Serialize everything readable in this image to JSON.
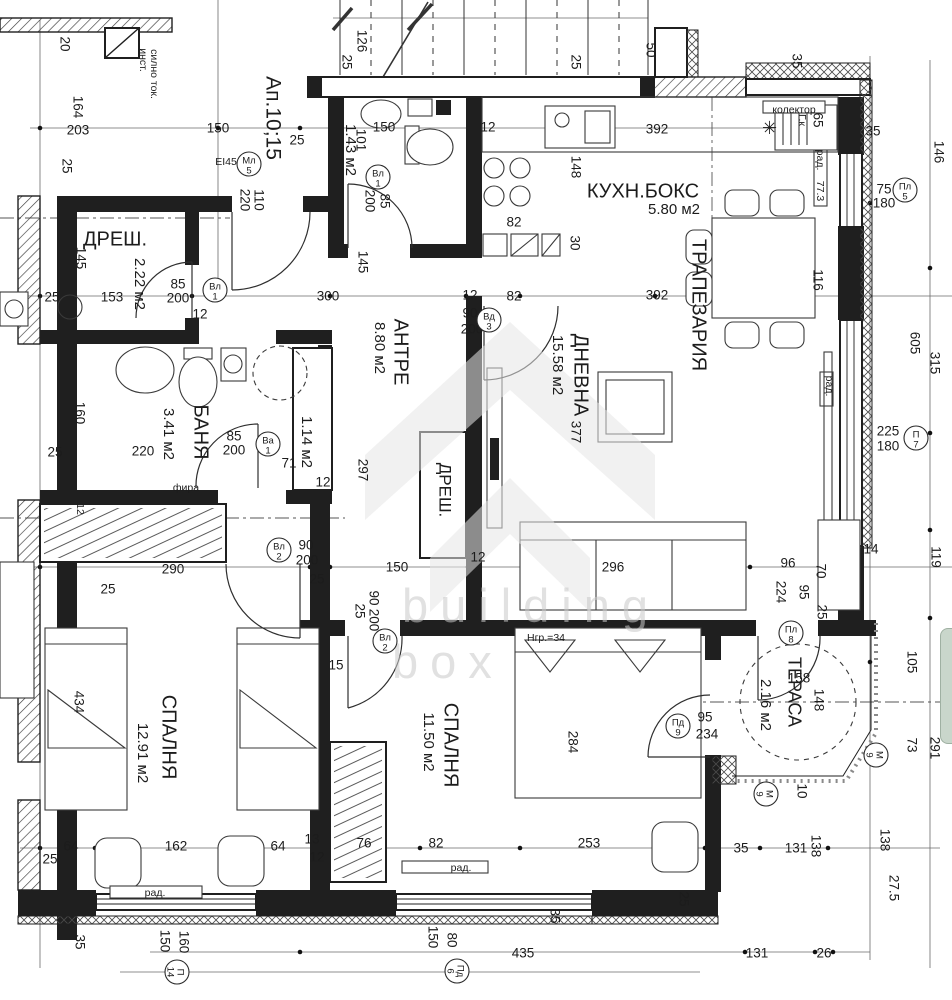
{
  "watermark": {
    "l1": "building",
    "l2": "box"
  },
  "colors": {
    "paper": "#ffffff",
    "ink": "#1f1f1f",
    "watermark": "#c9c9c9",
    "side_tab": "#c9d6cb"
  },
  "labels": [
    {
      "t": "20",
      "x": 64,
      "y": 44,
      "r": 90
    },
    {
      "t": "инст.",
      "x": 143,
      "y": 60,
      "r": 90,
      "k": "small"
    },
    {
      "t": "силно ток.",
      "x": 154,
      "y": 74,
      "r": 90,
      "k": "small"
    },
    {
      "t": "164",
      "x": 77,
      "y": 107,
      "r": 90
    },
    {
      "t": "203",
      "x": 78,
      "y": 131
    },
    {
      "t": "150",
      "x": 218,
      "y": 129
    },
    {
      "t": "25",
      "x": 297,
      "y": 141
    },
    {
      "t": "Ап.10;15",
      "x": 272,
      "y": 118,
      "r": 90,
      "k": "title"
    },
    {
      "t": "25",
      "x": 66,
      "y": 166,
      "r": 90
    },
    {
      "t": "EI45",
      "x": 226,
      "y": 162,
      "k": "small"
    },
    {
      "t": "110",
      "x": 258,
      "y": 200,
      "r": 90
    },
    {
      "t": "220",
      "x": 244,
      "y": 200,
      "r": 90
    },
    {
      "t": "126",
      "x": 361,
      "y": 41,
      "r": 90
    },
    {
      "t": "25",
      "x": 346,
      "y": 62,
      "r": 90
    },
    {
      "t": "25",
      "x": 575,
      "y": 62,
      "r": 90
    },
    {
      "t": "50",
      "x": 650,
      "y": 50,
      "r": 90
    },
    {
      "t": "35",
      "x": 796,
      "y": 61,
      "r": 90
    },
    {
      "t": "колектор",
      "x": 794,
      "y": 110,
      "k": "small"
    },
    {
      "t": "Г.к",
      "x": 802,
      "y": 120,
      "r": 90,
      "k": "small"
    },
    {
      "t": "65",
      "x": 817,
      "y": 120,
      "r": 90
    },
    {
      "t": "35",
      "x": 873,
      "y": 132
    },
    {
      "t": "1.43 м2",
      "x": 350,
      "y": 150,
      "r": 90,
      "k": "area"
    },
    {
      "t": "101",
      "x": 360,
      "y": 140,
      "r": 90
    },
    {
      "t": "150",
      "x": 384,
      "y": 128
    },
    {
      "t": "12",
      "x": 488,
      "y": 128
    },
    {
      "t": "392",
      "x": 657,
      "y": 130
    },
    {
      "t": "КУХН.БОКС",
      "x": 643,
      "y": 192,
      "k": "room"
    },
    {
      "t": "5.80 м2",
      "x": 674,
      "y": 210,
      "k": "area"
    },
    {
      "t": "рад.",
      "x": 820,
      "y": 160,
      "r": 90,
      "k": "small"
    },
    {
      "t": "77.3",
      "x": 820,
      "y": 191,
      "r": 90,
      "k": "small"
    },
    {
      "t": "75",
      "x": 884,
      "y": 190
    },
    {
      "t": "180",
      "x": 884,
      "y": 204
    },
    {
      "t": "146",
      "x": 938,
      "y": 152,
      "r": 90
    },
    {
      "t": "85",
      "x": 384,
      "y": 201,
      "r": 90
    },
    {
      "t": "200",
      "x": 369,
      "y": 201,
      "r": 90
    },
    {
      "t": "82",
      "x": 514,
      "y": 223
    },
    {
      "t": "148",
      "x": 575,
      "y": 167,
      "r": 90
    },
    {
      "t": "30",
      "x": 574,
      "y": 243,
      "r": 90
    },
    {
      "t": "ТРАПЕЗАРИЯ",
      "x": 698,
      "y": 305,
      "r": 90,
      "k": "room"
    },
    {
      "t": "116",
      "x": 817,
      "y": 280,
      "r": 90
    },
    {
      "t": "145",
      "x": 362,
      "y": 262,
      "r": 90
    },
    {
      "t": "ДРЕШ.",
      "x": 115,
      "y": 240,
      "k": "room"
    },
    {
      "t": "2.22 м2",
      "x": 139,
      "y": 284,
      "r": 90,
      "k": "area"
    },
    {
      "t": "145",
      "x": 80,
      "y": 258,
      "r": 90
    },
    {
      "t": "85",
      "x": 178,
      "y": 285
    },
    {
      "t": "200",
      "x": 178,
      "y": 299
    },
    {
      "t": "153",
      "x": 112,
      "y": 298
    },
    {
      "t": "25",
      "x": 52,
      "y": 298
    },
    {
      "t": "12",
      "x": 200,
      "y": 315
    },
    {
      "t": "300",
      "x": 328,
      "y": 297
    },
    {
      "t": "12",
      "x": 470,
      "y": 296
    },
    {
      "t": "82",
      "x": 514,
      "y": 297
    },
    {
      "t": "392",
      "x": 657,
      "y": 296
    },
    {
      "t": "90",
      "x": 470,
      "y": 314
    },
    {
      "t": "200",
      "x": 472,
      "y": 330
    },
    {
      "t": "АНТРЕ",
      "x": 400,
      "y": 352,
      "r": 90,
      "k": "room"
    },
    {
      "t": "8.80 м2",
      "x": 379,
      "y": 348,
      "r": 90,
      "k": "area"
    },
    {
      "t": "ДНЕВНА",
      "x": 580,
      "y": 375,
      "r": 90,
      "k": "room"
    },
    {
      "t": "15.58 м2",
      "x": 557,
      "y": 365,
      "r": 90,
      "k": "area"
    },
    {
      "t": "377",
      "x": 575,
      "y": 432,
      "r": 90
    },
    {
      "t": "160",
      "x": 79,
      "y": 413,
      "r": 90
    },
    {
      "t": "БАНЯ",
      "x": 200,
      "y": 432,
      "r": 90,
      "k": "room"
    },
    {
      "t": "3.41 м2",
      "x": 168,
      "y": 434,
      "r": 90,
      "k": "area"
    },
    {
      "t": "220",
      "x": 143,
      "y": 452
    },
    {
      "t": "85",
      "x": 234,
      "y": 437
    },
    {
      "t": "200",
      "x": 234,
      "y": 451
    },
    {
      "t": "1.14 м2",
      "x": 306,
      "y": 442,
      "r": 90,
      "k": "area"
    },
    {
      "t": "71",
      "x": 289,
      "y": 464
    },
    {
      "t": "12",
      "x": 323,
      "y": 483
    },
    {
      "t": "фира",
      "x": 186,
      "y": 488,
      "k": "small"
    },
    {
      "t": "25",
      "x": 55,
      "y": 453
    },
    {
      "t": "297",
      "x": 362,
      "y": 470,
      "r": 90
    },
    {
      "t": "ДРЕШ.",
      "x": 444,
      "y": 490,
      "r": 90,
      "k": "room",
      "s": 17
    },
    {
      "t": "225",
      "x": 888,
      "y": 432
    },
    {
      "t": "180",
      "x": 888,
      "y": 447
    },
    {
      "t": "605",
      "x": 914,
      "y": 343,
      "r": 90
    },
    {
      "t": "315",
      "x": 934,
      "y": 363,
      "r": 90
    },
    {
      "t": "рад.",
      "x": 829,
      "y": 386,
      "r": 90,
      "k": "small"
    },
    {
      "t": "12",
      "x": 80,
      "y": 509,
      "r": 90,
      "k": "small"
    },
    {
      "t": "290",
      "x": 173,
      "y": 570
    },
    {
      "t": "25",
      "x": 108,
      "y": 590
    },
    {
      "t": "150",
      "x": 397,
      "y": 568
    },
    {
      "t": "12",
      "x": 478,
      "y": 558
    },
    {
      "t": "296",
      "x": 613,
      "y": 568
    },
    {
      "t": "96",
      "x": 788,
      "y": 564
    },
    {
      "t": "90",
      "x": 306,
      "y": 546
    },
    {
      "t": "200",
      "x": 307,
      "y": 561
    },
    {
      "t": "25",
      "x": 317,
      "y": 580
    },
    {
      "t": "224",
      "x": 780,
      "y": 592,
      "r": 90
    },
    {
      "t": "95",
      "x": 803,
      "y": 592,
      "r": 90
    },
    {
      "t": "70",
      "x": 820,
      "y": 571,
      "r": 90
    },
    {
      "t": "25",
      "x": 821,
      "y": 612,
      "r": 90
    },
    {
      "t": "14",
      "x": 871,
      "y": 550
    },
    {
      "t": "119",
      "x": 935,
      "y": 557,
      "r": 90
    },
    {
      "t": "СПАЛНЯ",
      "x": 168,
      "y": 737,
      "r": 90,
      "k": "room"
    },
    {
      "t": "12.91 м2",
      "x": 142,
      "y": 753,
      "r": 90,
      "k": "area"
    },
    {
      "t": "434",
      "x": 78,
      "y": 702,
      "r": 90
    },
    {
      "t": "СПАЛНЯ",
      "x": 450,
      "y": 745,
      "r": 90,
      "k": "room"
    },
    {
      "t": "11.50 м2",
      "x": 428,
      "y": 742,
      "r": 90,
      "k": "area"
    },
    {
      "t": "284",
      "x": 572,
      "y": 742,
      "r": 90
    },
    {
      "t": "Нгр.=34",
      "x": 546,
      "y": 638,
      "k": "small"
    },
    {
      "t": "90",
      "x": 373,
      "y": 598,
      "r": 90
    },
    {
      "t": "200",
      "x": 373,
      "y": 620,
      "r": 90
    },
    {
      "t": "25",
      "x": 359,
      "y": 611,
      "r": 90
    },
    {
      "t": "15",
      "x": 336,
      "y": 666
    },
    {
      "t": "ТЕРАСА",
      "x": 793,
      "y": 692,
      "r": 90,
      "k": "room",
      "s": 18
    },
    {
      "t": "2.16 м2",
      "x": 765,
      "y": 705,
      "r": 90,
      "k": "area"
    },
    {
      "t": "158",
      "x": 799,
      "y": 679
    },
    {
      "t": "148",
      "x": 818,
      "y": 700,
      "r": 90
    },
    {
      "t": "95",
      "x": 705,
      "y": 718
    },
    {
      "t": "234",
      "x": 707,
      "y": 735
    },
    {
      "t": "105",
      "x": 911,
      "y": 662,
      "r": 90
    },
    {
      "t": "73",
      "x": 911,
      "y": 745,
      "r": 90
    },
    {
      "t": "291",
      "x": 934,
      "y": 748,
      "r": 90
    },
    {
      "t": "10",
      "x": 801,
      "y": 791,
      "r": 90
    },
    {
      "t": "64",
      "x": 71,
      "y": 847
    },
    {
      "t": "162",
      "x": 176,
      "y": 847
    },
    {
      "t": "64",
      "x": 278,
      "y": 847
    },
    {
      "t": "13",
      "x": 312,
      "y": 840
    },
    {
      "t": "12",
      "x": 317,
      "y": 858
    },
    {
      "t": "25",
      "x": 50,
      "y": 860
    },
    {
      "t": "76",
      "x": 364,
      "y": 844
    },
    {
      "t": "82",
      "x": 436,
      "y": 844
    },
    {
      "t": "253",
      "x": 589,
      "y": 844
    },
    {
      "t": "35",
      "x": 741,
      "y": 849
    },
    {
      "t": "131",
      "x": 796,
      "y": 849
    },
    {
      "t": "138",
      "x": 815,
      "y": 846,
      "r": 90
    },
    {
      "t": "138",
      "x": 884,
      "y": 840,
      "r": 90
    },
    {
      "t": "рад.",
      "x": 155,
      "y": 893,
      "k": "small"
    },
    {
      "t": "рад.",
      "x": 461,
      "y": 868,
      "k": "small"
    },
    {
      "t": "27.5",
      "x": 893,
      "y": 888,
      "r": 90
    },
    {
      "t": "35",
      "x": 554,
      "y": 916,
      "r": 90
    },
    {
      "t": "25",
      "x": 683,
      "y": 899,
      "r": 90
    },
    {
      "t": "150",
      "x": 164,
      "y": 941,
      "r": 90
    },
    {
      "t": "160",
      "x": 183,
      "y": 942,
      "r": 90
    },
    {
      "t": "150",
      "x": 432,
      "y": 937,
      "r": 90
    },
    {
      "t": "80",
      "x": 451,
      "y": 940,
      "r": 90
    },
    {
      "t": "35",
      "x": 79,
      "y": 942,
      "r": 90
    },
    {
      "t": "435",
      "x": 523,
      "y": 954
    },
    {
      "t": "131",
      "x": 757,
      "y": 954
    },
    {
      "t": "26",
      "x": 824,
      "y": 954
    }
  ],
  "door_tags": [
    {
      "l1": "Мл",
      "l2": "5",
      "x": 249,
      "y": 164
    },
    {
      "l1": "Вл",
      "l2": "1",
      "x": 215,
      "y": 290
    },
    {
      "l1": "Вл",
      "l2": "1",
      "x": 378,
      "y": 177
    },
    {
      "l1": "Вд",
      "l2": "3",
      "x": 489,
      "y": 320
    },
    {
      "l1": "Ва",
      "l2": "1",
      "x": 268,
      "y": 444
    },
    {
      "l1": "Вл",
      "l2": "2",
      "x": 279,
      "y": 550
    },
    {
      "l1": "Вл",
      "l2": "2",
      "x": 385,
      "y": 641
    },
    {
      "l1": "Пл",
      "l2": "5",
      "x": 905,
      "y": 190
    },
    {
      "l1": "П",
      "l2": "7",
      "x": 916,
      "y": 438
    },
    {
      "l1": "Пл",
      "l2": "8",
      "x": 791,
      "y": 633
    },
    {
      "l1": "Пд",
      "l2": "9",
      "x": 678,
      "y": 726
    },
    {
      "l1": "М",
      "l2": "9",
      "x": 876,
      "y": 755,
      "r": 90
    },
    {
      "l1": "М",
      "l2": "9",
      "x": 766,
      "y": 794,
      "r": 90
    },
    {
      "l1": "П",
      "l2": "14",
      "x": 177,
      "y": 972,
      "r": 90
    },
    {
      "l1": "Пд",
      "l2": "6",
      "x": 457,
      "y": 971,
      "r": 90
    }
  ]
}
